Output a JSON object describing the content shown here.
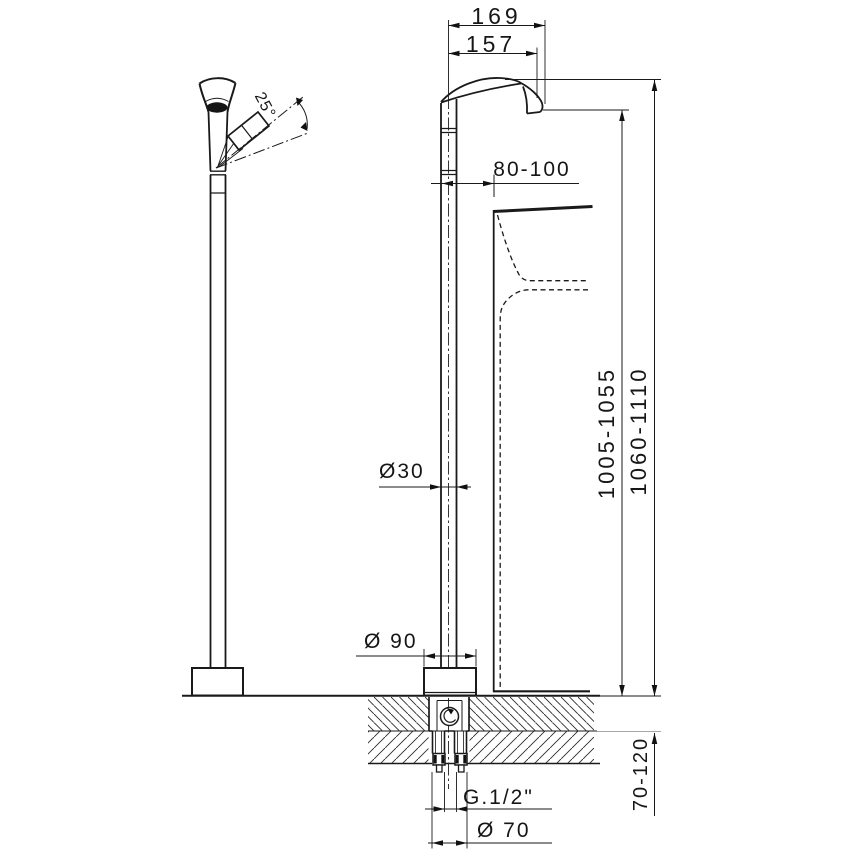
{
  "drawing": {
    "colors": {
      "line": "#1a1a1a",
      "background": "#ffffff"
    },
    "labels": {
      "width_outer": "169",
      "width_inner": "157",
      "handle_swing_angle": "25°",
      "spout_overhang": "80-100",
      "column_diameter": "Ø30",
      "outlet_height": "1005-1055",
      "overall_height": "1060-1110",
      "base_diameter": "Ø 90",
      "floor_recess_depth": "70-120",
      "connection_thread": "G.1/2\"",
      "rough_in_diameter": "Ø 70"
    }
  }
}
